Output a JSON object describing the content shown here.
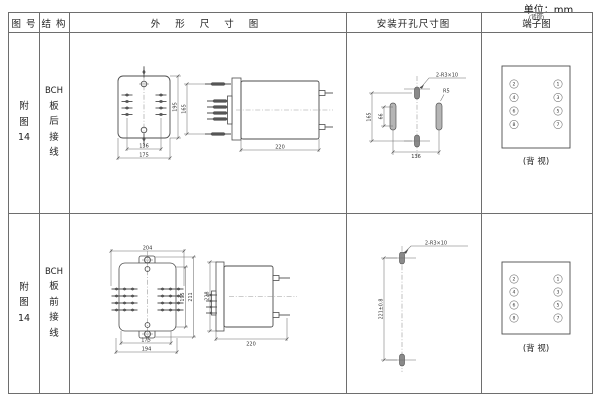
{
  "unit_label": "单位：mm",
  "header": {
    "figure": "图 号",
    "structure": "结 构",
    "outline": "外 形 尺 寸 图",
    "mounting": "安装开孔尺寸图",
    "terminal_small": "(背视)",
    "terminal": "端子图"
  },
  "rows": [
    {
      "figure": [
        "附",
        "图",
        "14"
      ],
      "structure": [
        "BCH",
        "板",
        "后",
        "接",
        "线"
      ],
      "outline_dims": {
        "inner_width": "136",
        "outer_width": "175",
        "height": "195",
        "pin_span": "165",
        "depth": "220"
      },
      "mounting_dims": {
        "hole_label": "2-R3×10",
        "slot_label": "R5",
        "vertical": "165",
        "slot_length": "66",
        "horizontal": "136"
      },
      "terminal": {
        "left": [
          "2",
          "4",
          "6",
          "8"
        ],
        "right": [
          "1",
          "3",
          "5",
          "7"
        ],
        "caption": "(背 视)"
      }
    },
    {
      "figure": [
        "附",
        "图",
        "14"
      ],
      "structure": [
        "BCH",
        "板",
        "前",
        "接",
        "线"
      ],
      "outline_dims": {
        "top_width": "204",
        "inner_height": "195",
        "outer_height": "211",
        "side_height": "228",
        "inner_width": "175",
        "outer_width": "194",
        "depth": "220"
      },
      "mounting_dims": {
        "hole_label": "2-R3×10",
        "vertical": "221±0.8"
      },
      "terminal": {
        "left": [
          "2",
          "4",
          "6",
          "8"
        ],
        "right": [
          "1",
          "3",
          "5",
          "7"
        ],
        "caption": "(背 视)"
      }
    }
  ]
}
